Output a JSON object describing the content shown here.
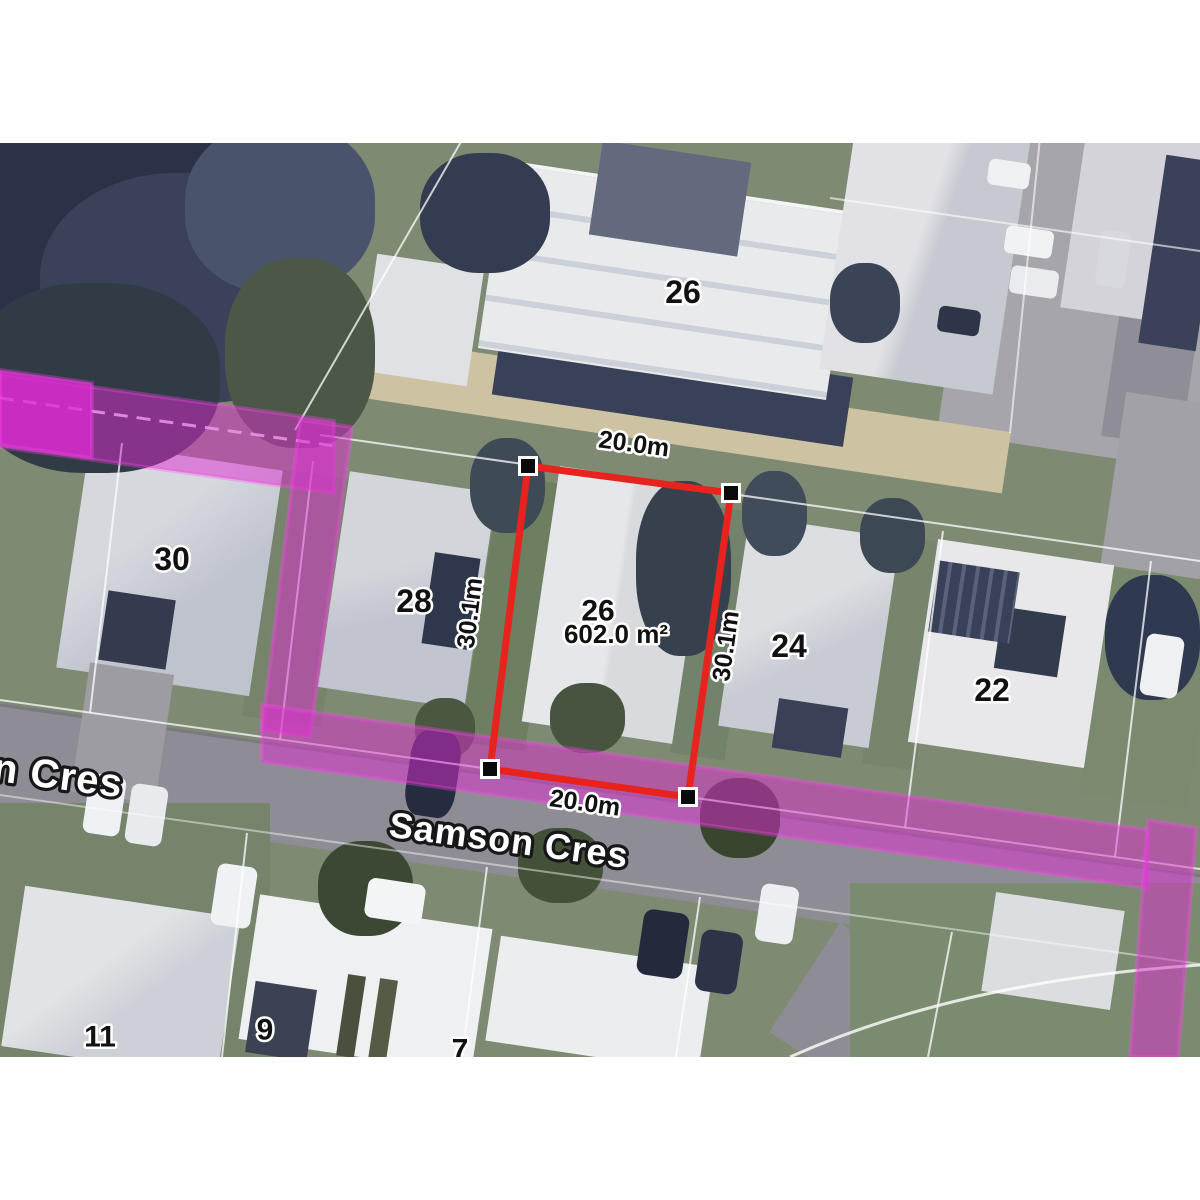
{
  "map": {
    "street": {
      "label_full": "Samson Cres",
      "label_partial": "n Cres"
    },
    "highlighted_lot": {
      "house_number": "26",
      "area": "602.0 m²",
      "dim_top": "20.0m",
      "dim_bottom": "20.0m",
      "dim_left": "30.1m",
      "dim_right": "30.1m"
    },
    "house_numbers": {
      "top_26": "26",
      "n30": "30",
      "n28": "28",
      "n24": "24",
      "n22": "22",
      "n11": "11",
      "n9": "9",
      "n7": "7"
    },
    "colors": {
      "lot_boundary_red": "#e8231d",
      "highlight_magenta": "#dd2bd2",
      "road_grey": "#8e8c94",
      "lawn_green": "#7f8a73"
    }
  }
}
